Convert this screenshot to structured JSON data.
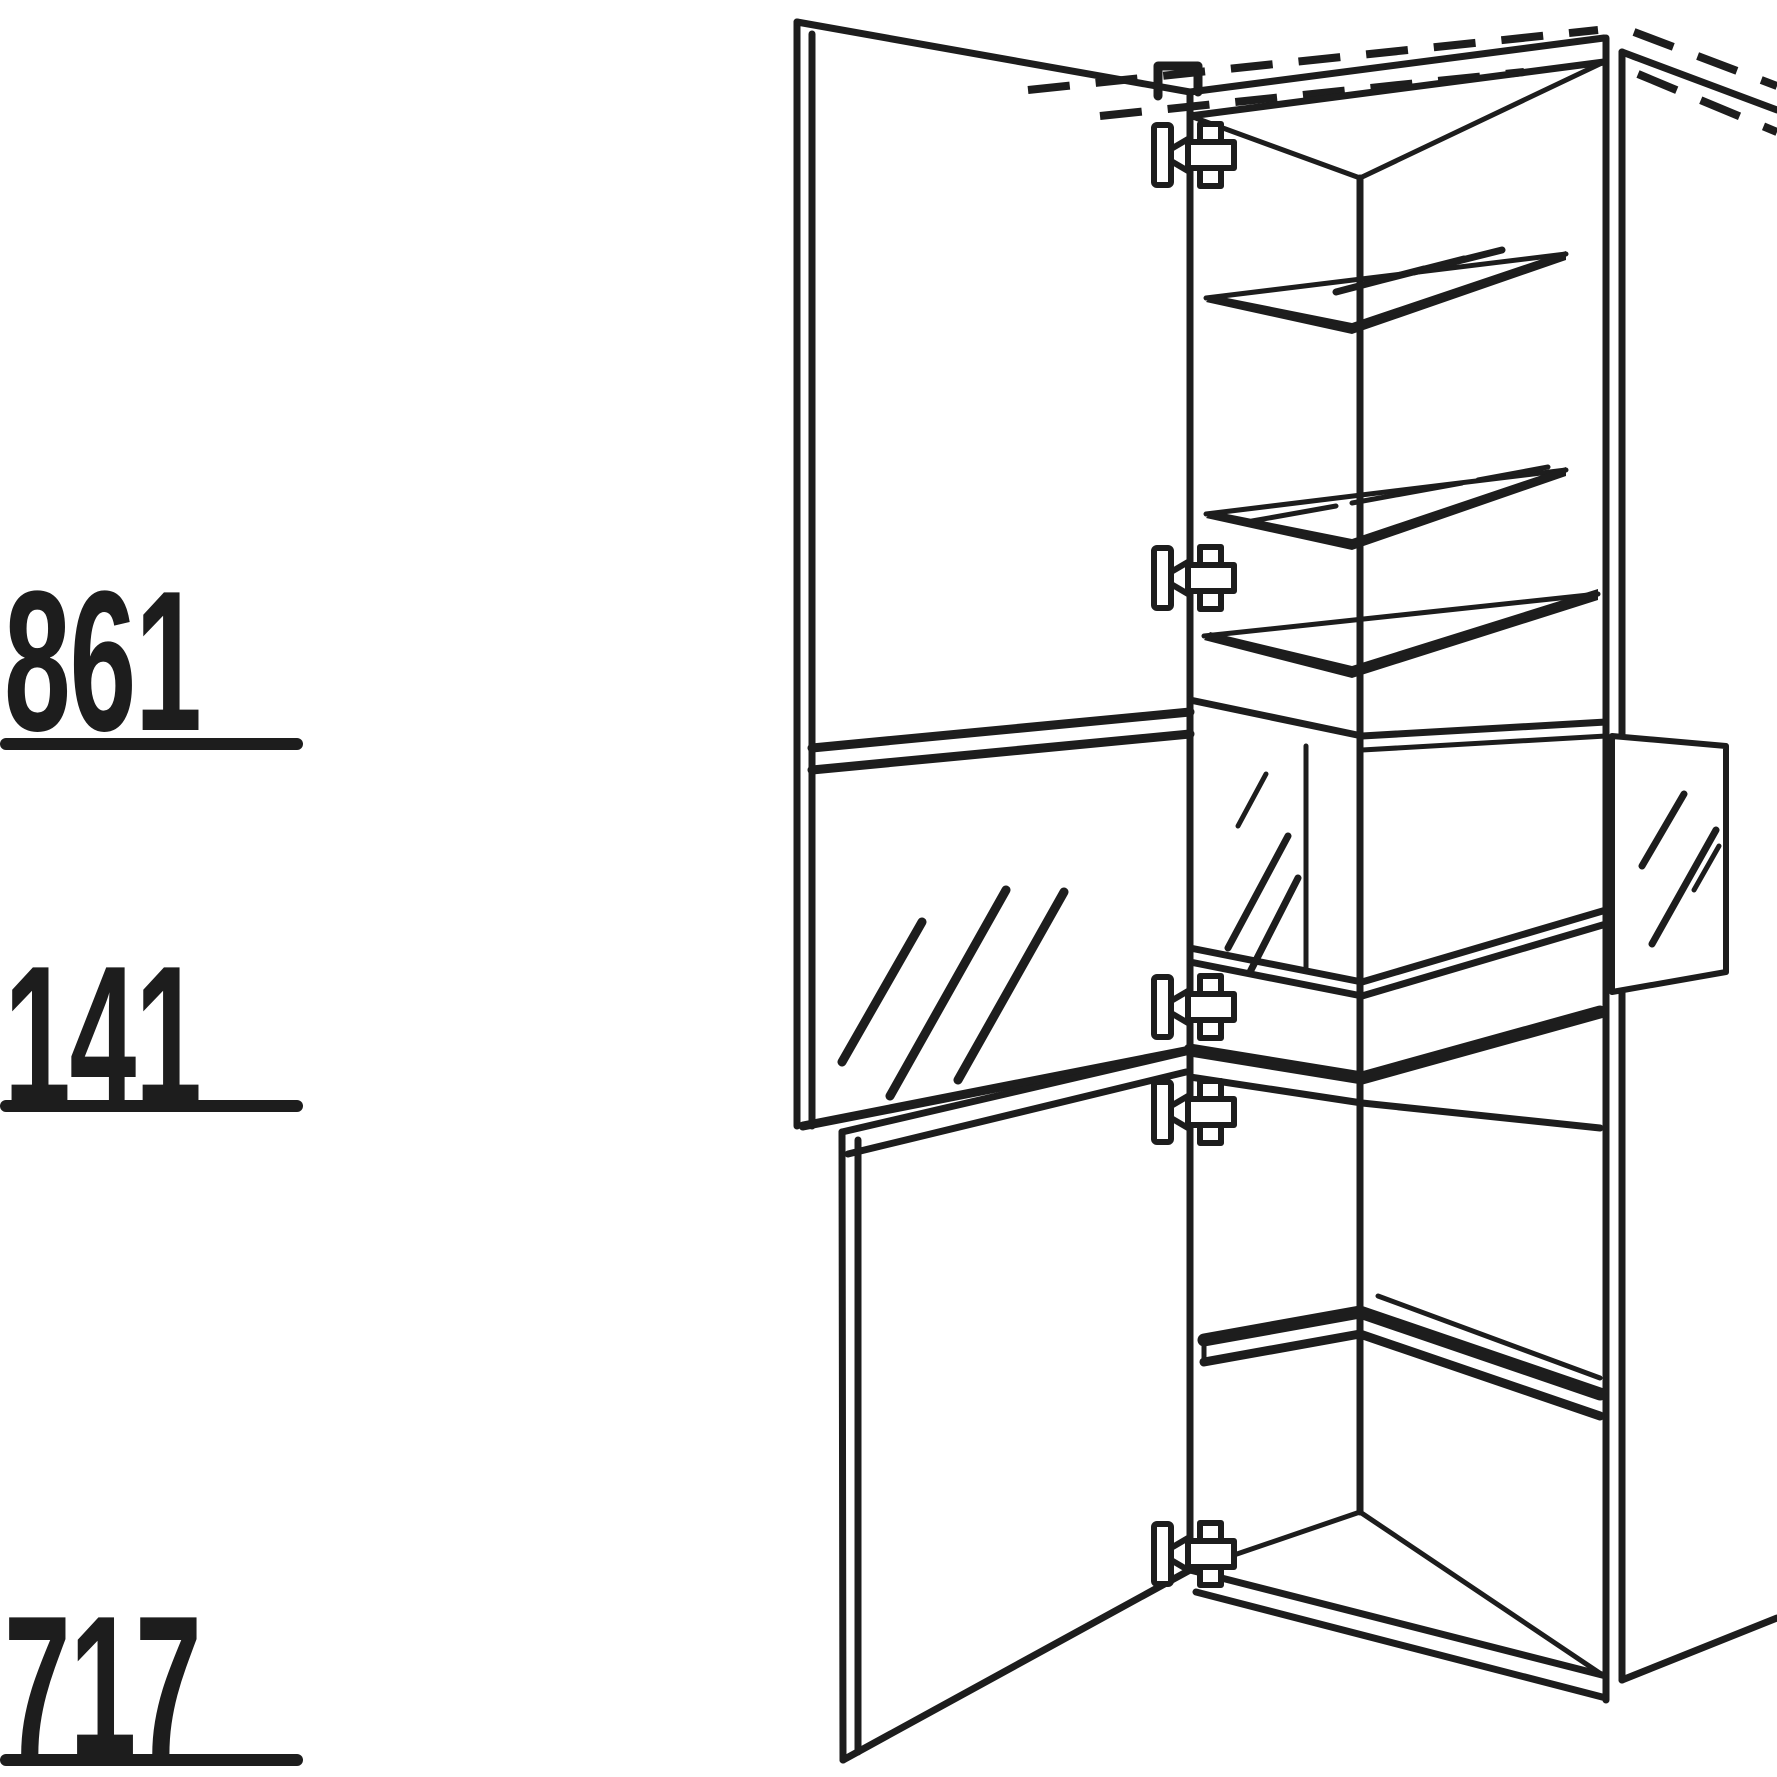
{
  "canvas": {
    "width": 1777,
    "height": 1777,
    "background_color": "#ffffff",
    "ink_color": "#1d1d1d"
  },
  "dimension_labels": [
    {
      "position": "top",
      "value": "861"
    },
    {
      "position": "middle",
      "value": "141"
    },
    {
      "position": "bottom",
      "value": "717"
    }
  ],
  "drawing": {
    "subject": "tall-cabinet-technical-line-drawing",
    "features": [
      "dashed-ceiling-continuation-lines",
      "open-upper-door-with-glass-panel",
      "glass-display-mid-section",
      "right-side-glass-panel",
      "glass-shelves-with-zigzag-marks",
      "lower-wood-shelf",
      "open-lower-door",
      "five-cup-hinges"
    ]
  }
}
